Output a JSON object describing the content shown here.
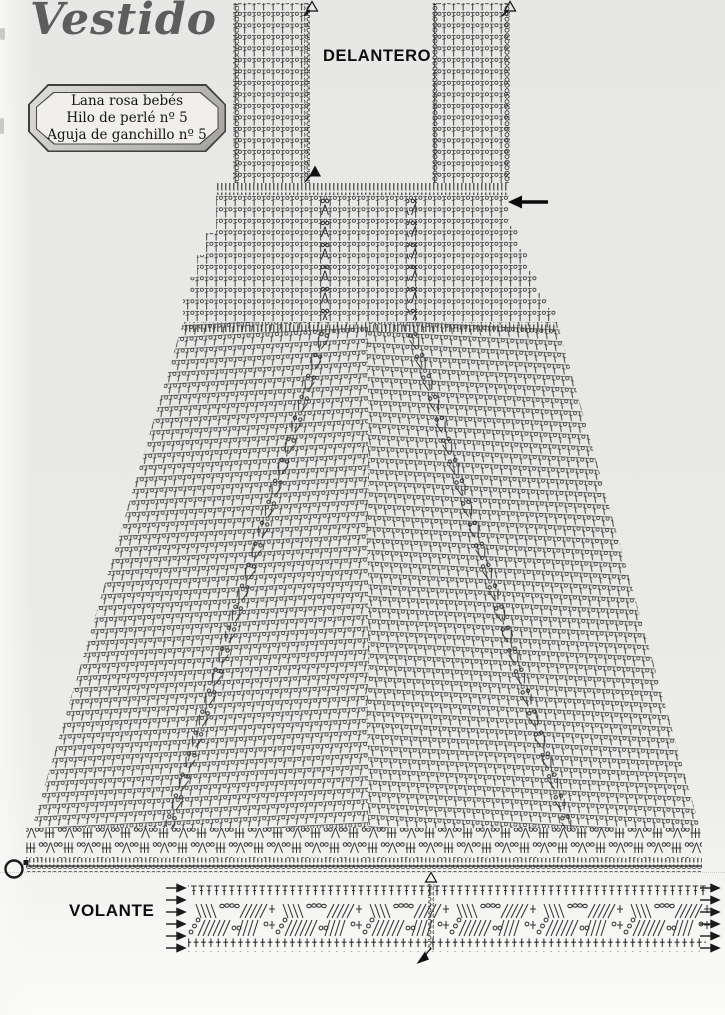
{
  "page": {
    "title": "Vestido"
  },
  "materials_box": {
    "lines": [
      "Lana rosa bebés",
      "Hilo de perlé nº 5",
      "Aguja de ganchillo nº 5"
    ]
  },
  "sections": {
    "front_label": "DELANTERO",
    "ruffle_label": "VOLANTE"
  },
  "colors": {
    "paper": "#e9e9e7",
    "ink": "#2e2e2e",
    "title_gray": "#5d5d5d",
    "box_fill": "#f0efeb",
    "box_bevel": "#b9b7b4"
  }
}
